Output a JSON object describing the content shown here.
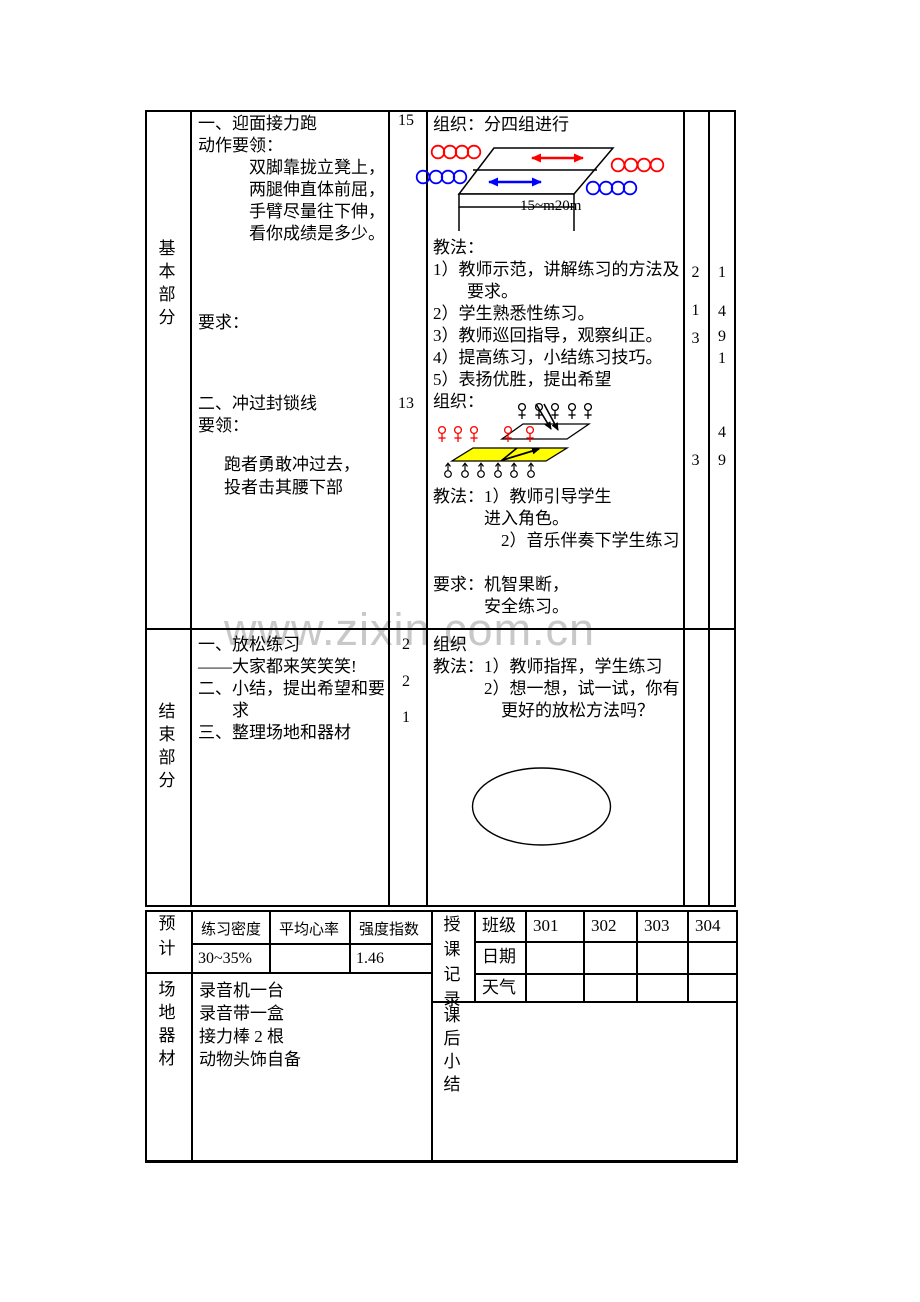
{
  "page": {
    "watermark": "www.zixin.com.cn"
  },
  "colors": {
    "red": "#ff0000",
    "blue": "#0000ff",
    "yellow": "#ffff00",
    "line": "#000000",
    "watermark": "#c8c8c8"
  },
  "basic": {
    "section_label": "基\n本\n部\n分",
    "item1": "一、迎面接力跑\n动作要领：\n　　　双脚靠拢立凳上，\n　　　两腿伸直体前屈，\n　　　手臂尽量往下伸，\n　　　看你成绩是多少。",
    "req1": "要求：",
    "item2": "二、冲过封锁线\n要领：",
    "item2_detail": "跑者勇敢冲过去，\n投者击其腰下部",
    "time1": "15",
    "time2": "13",
    "org1": "组织：分四组进行",
    "distance_label": "15~m20m",
    "methods1": "教法：\n1）教师示范，讲解练习的方法及\n　　要求。\n2）学生熟悉性练习。\n3）教师巡回指导，观察纠正。\n4）提高练习，小结练习技巧。\n5）表扬优胜，提出希望\n组织：",
    "methods2": "教法：1）教师引导学生\n　　　进入角色。\n　　　　2）音乐伴奏下学生练习",
    "req2": "要求：机智果断，\n　　　安全练习。",
    "col5_counts": [
      "2",
      "1",
      "3",
      "3"
    ],
    "col6_counts": [
      "1",
      "4",
      "9",
      "1",
      "4",
      "9"
    ]
  },
  "ending": {
    "section_label": "结\n束\n部\n分",
    "items": "一、放松练习\n——大家都来笑笑笑!\n二、小结，提出希望和要\n　　求\n三、整理场地和器材",
    "times": [
      "2",
      "2",
      "1"
    ],
    "org": "组织\n教法：1）教师指挥，学生练习\n　　　2）想一想，试一试，你有\n　　　　更好的放松方法吗？"
  },
  "forecast": {
    "section_label": "预\n计",
    "headers": [
      "练习密度",
      "平均心率",
      "强度指数"
    ],
    "values": [
      "30~35%",
      "",
      "1.46"
    ]
  },
  "venue": {
    "section_label": "场\n地\n器\n材",
    "items": "录音机一台\n录音带一盒\n接力棒 2 根\n动物头饰自备"
  },
  "record": {
    "section_label": "授\n课\n记\n录",
    "rows": [
      {
        "label": "班级",
        "cells": [
          "301",
          "302",
          "303",
          "304"
        ]
      },
      {
        "label": "日期",
        "cells": [
          "",
          "",
          "",
          ""
        ]
      },
      {
        "label": "天气",
        "cells": [
          "",
          "",
          "",
          ""
        ]
      }
    ]
  },
  "summary": {
    "section_label": "课\n后\n小\n结"
  }
}
